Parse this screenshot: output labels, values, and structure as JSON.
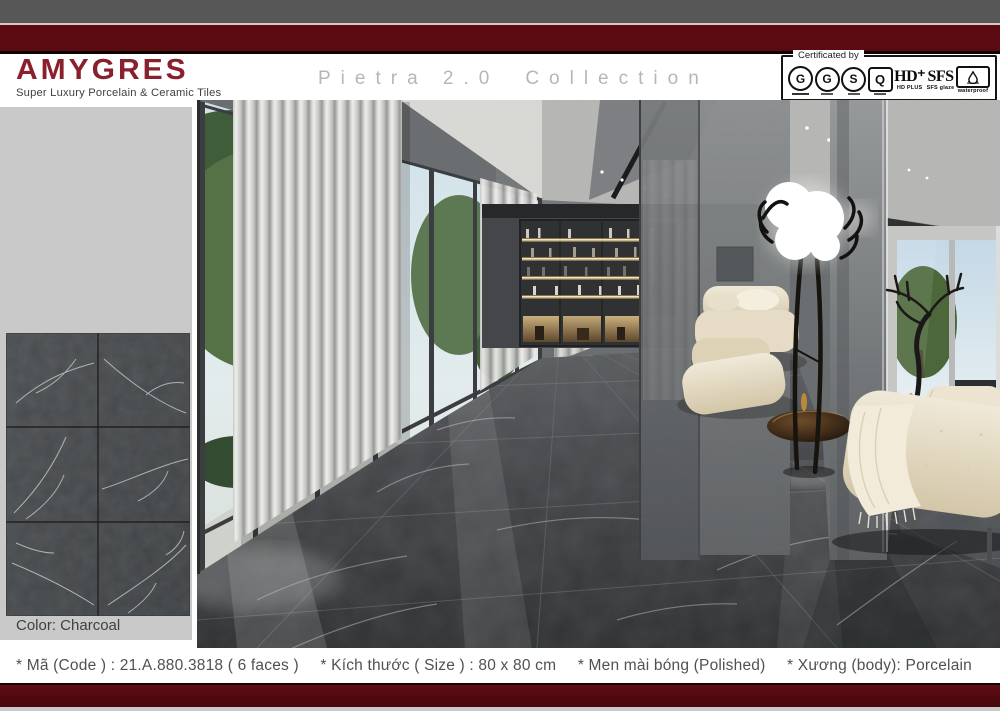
{
  "header": {
    "brand": "AMYGRES",
    "tagline": "Super Luxury Porcelain & Ceramic Tiles",
    "collection_name": "Pietra 2.0",
    "collection_word": "Collection",
    "certification": {
      "label": "Certificated by",
      "logos": {
        "g_iso": "G",
        "g_japan": "G",
        "s_mark": "S",
        "quacert": "Q",
        "hd": "HD⁺",
        "hd_caption": "HD PLUS",
        "sfs": "SFS",
        "sfs_caption": "SFS glaze",
        "waterproof_caption": "waterproof"
      }
    }
  },
  "sidebar": {
    "color_label": "Color: Charcoal"
  },
  "specs": [
    "* Mã (Code ) : 21.A.880.3818 ( 6 faces )",
    "* Kích thước ( Size ) : 80 x 80 cm",
    "* Men mài bóng (Polished)",
    "* Xương (body): Porcelain"
  ],
  "colors": {
    "brand_red": "#8a1f2e",
    "maroon_bar": "#5c0a11",
    "top_gray_bar": "#575757",
    "sidebar_gray": "#c8c9c8",
    "tile_charcoal": "#46494b",
    "spec_text_gray": "#4f5153"
  }
}
